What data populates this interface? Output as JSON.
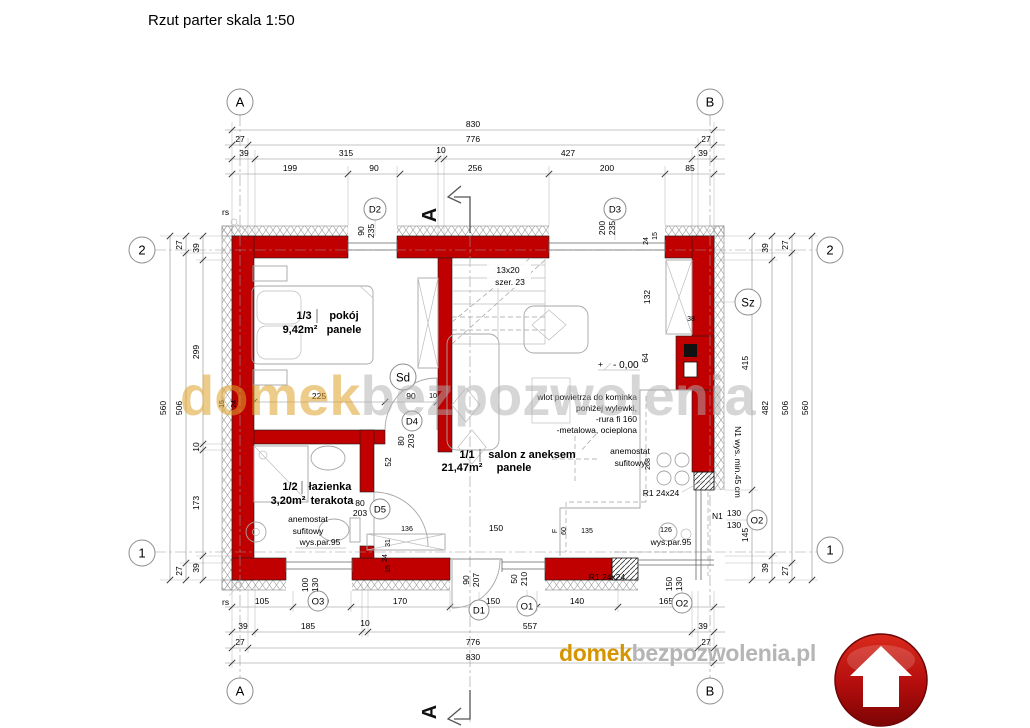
{
  "title": "Rzut parter skala 1:50",
  "grid": {
    "col_a": "A",
    "col_b": "B",
    "row_1": "1",
    "row_2": "2"
  },
  "section_marker": "A",
  "watermark": {
    "orange": "domek",
    "gray": "bezpozwolenia"
  },
  "logo": {
    "orange": "domek",
    "gray": "bezpozwolenia.pl"
  },
  "colors": {
    "wall_red": "#c00000",
    "logo_orange": "#d69500",
    "logo_gray": "#b5b5b5",
    "badge_red": "#9d0b0b"
  },
  "rooms": {
    "pokoj": {
      "num": "1/3",
      "name": "pokój",
      "area": "9,42m²",
      "floor": "panele"
    },
    "lazienka": {
      "num": "1/2",
      "name": "łazienka",
      "area": "3,20m²",
      "floor": "terakota"
    },
    "salon": {
      "num": "1/1",
      "name": "salon z aneksem",
      "area": "21,47m²",
      "floor": "panele"
    }
  },
  "openings": {
    "d1": {
      "id": "D1",
      "w": "90",
      "h": "207"
    },
    "d2": {
      "id": "D2",
      "w": "90",
      "h": "235"
    },
    "d3": {
      "id": "D3",
      "w": "200",
      "h": "235"
    },
    "d4": {
      "id": "D4",
      "w": "80",
      "h": "203"
    },
    "d5": {
      "id": "D5",
      "w": "80",
      "h": "203"
    },
    "o1": {
      "id": "O1",
      "w": "50",
      "h": "210"
    },
    "o2_bottom": {
      "id": "O2",
      "w": "150",
      "h": "130"
    },
    "o2_right": {
      "id": "O2",
      "w": "130",
      "h": "130"
    },
    "o3": {
      "id": "O3",
      "w": "100",
      "h": "130"
    }
  },
  "symbols": {
    "sd": "Sd",
    "sz": "Sz",
    "rs": "rs",
    "n1": "N1",
    "n1_note": "N1 wys. min.45 cm"
  },
  "annotations": {
    "stairs_line1": "13x20",
    "stairs_line2": "szer. 23",
    "level_plus": "+",
    "level_value": "- 0,00",
    "air_line1": "wlot powietrza do kominka",
    "air_line2": "poniżej wylewki,",
    "air_line3": "-rura fi 160",
    "air_line4": "-metalowa, ocieplona",
    "anemostat_line1": "anemostat",
    "anemostat_line2": "sufitowy",
    "parapet": "wys.par.95",
    "lintel": "R1 24x24"
  },
  "dims_top": {
    "total": "830",
    "row2": [
      "27",
      "776",
      "27"
    ],
    "row3": [
      "39",
      "315",
      "10",
      "427",
      "39"
    ],
    "row4": [
      "199",
      "90",
      "256",
      "200",
      "85"
    ]
  },
  "dims_bottom": {
    "row1": [
      "105",
      "100",
      "170",
      "150",
      "140",
      "165"
    ],
    "row2": [
      "39",
      "185",
      "10",
      "557",
      "39"
    ],
    "row3": [
      "27",
      "776",
      "27"
    ],
    "total": "830"
  },
  "dims_left": {
    "outer": "560",
    "mid": [
      "27",
      "506",
      "27"
    ],
    "inner": [
      "39",
      "299",
      "10",
      "173",
      "39"
    ],
    "axis": [
      "15",
      "24"
    ]
  },
  "dims_right": {
    "inner": [
      "415",
      "145"
    ],
    "mid": [
      "39",
      "482",
      "39"
    ],
    "outer_mid": [
      "27",
      "506",
      "27"
    ],
    "outer": "560",
    "corner": [
      "24",
      "15"
    ]
  },
  "dims_interior": {
    "pokoj": [
      "225",
      "90",
      "10"
    ],
    "fireplace": [
      "132",
      "38",
      "64"
    ],
    "bath": [
      "52",
      "136",
      "31",
      "24",
      "15"
    ],
    "kitchen": [
      "F",
      "60",
      "135",
      "126",
      "268"
    ],
    "salon": [
      "150"
    ]
  }
}
